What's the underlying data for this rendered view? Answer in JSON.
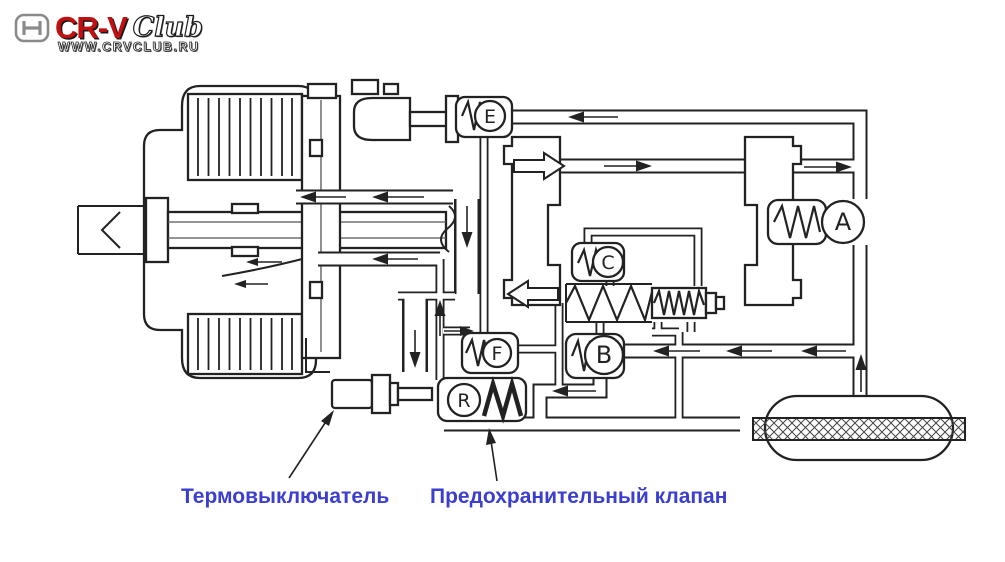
{
  "page": {
    "background": "#ffffff",
    "line_color": "#222222"
  },
  "logo": {
    "honda_icon": "honda-h-icon",
    "brand": "CR-V",
    "club": "Club",
    "url": "WWW.CRVCLUB.RU",
    "brand_color": "#c01010"
  },
  "diagram": {
    "type": "hydraulic-schematic",
    "valves": {
      "e": {
        "label": "E"
      },
      "a": {
        "label": "A"
      },
      "c": {
        "label": "C"
      },
      "b": {
        "label": "B"
      },
      "f": {
        "label": "F"
      },
      "r": {
        "label": "R"
      }
    },
    "captions": {
      "thermal_switch": "Термовыключатель",
      "relief_valve": "Предохранительный клапан",
      "color": "#3b3ecf"
    }
  }
}
